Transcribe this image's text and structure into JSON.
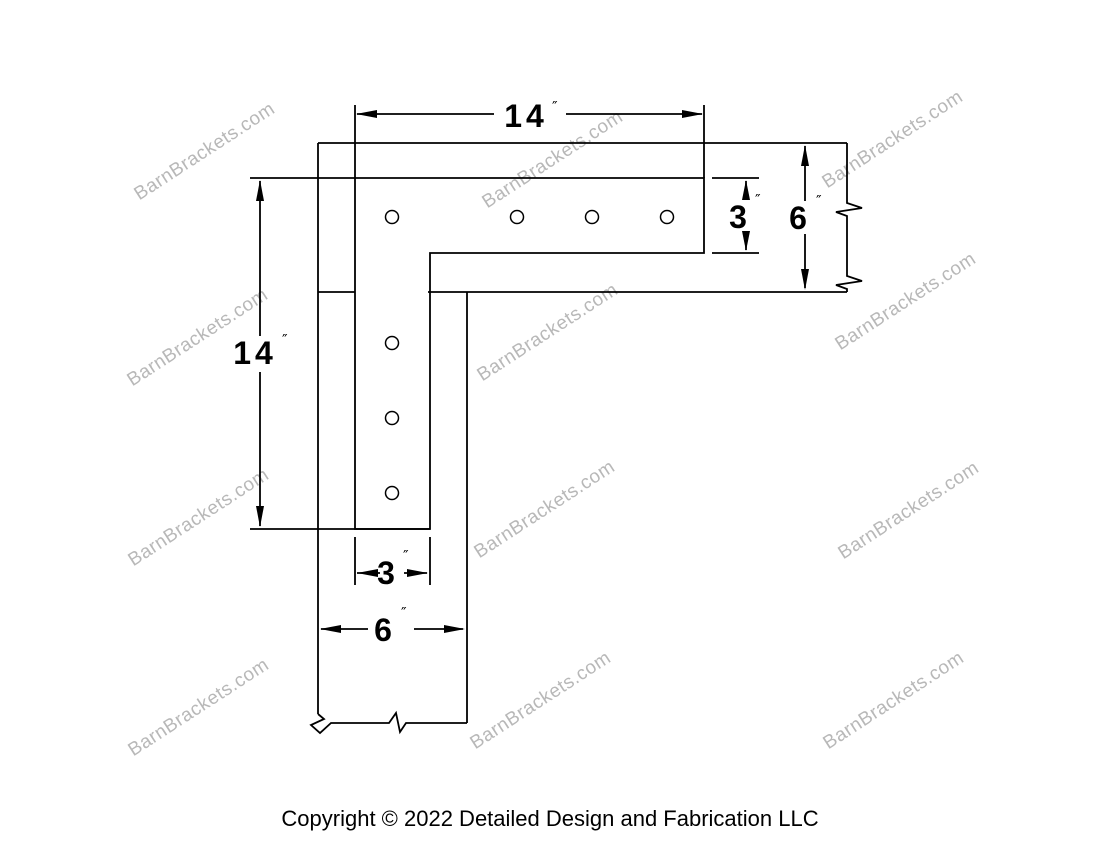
{
  "page": {
    "background": "#ffffff"
  },
  "drawing": {
    "name": "L shaped corner bracket dimension diagram",
    "line_color": "#000000",
    "dimensions": {
      "top_length": {
        "value": "14",
        "unit": "″"
      },
      "plate_height": {
        "value": "3",
        "unit": "″"
      },
      "beam_height": {
        "value": "6",
        "unit": "″"
      },
      "left_length": {
        "value": "14",
        "unit": "″"
      },
      "plate_width": {
        "value": "3",
        "unit": "″"
      },
      "beam_width": {
        "value": "6",
        "unit": "″"
      }
    },
    "holes": [
      {
        "x": 392,
        "y": 217
      },
      {
        "x": 517,
        "y": 217
      },
      {
        "x": 592,
        "y": 217
      },
      {
        "x": 667,
        "y": 217
      },
      {
        "x": 392,
        "y": 343
      },
      {
        "x": 392,
        "y": 418
      },
      {
        "x": 392,
        "y": 493
      }
    ],
    "hole_radius": 6.5
  },
  "watermark": {
    "text": "BarnBrackets.com",
    "color": "#b8b8b8",
    "positions": [
      {
        "x": 205,
        "y": 152
      },
      {
        "x": 553,
        "y": 160
      },
      {
        "x": 893,
        "y": 140
      },
      {
        "x": 198,
        "y": 338
      },
      {
        "x": 548,
        "y": 333
      },
      {
        "x": 906,
        "y": 302
      },
      {
        "x": 199,
        "y": 518
      },
      {
        "x": 545,
        "y": 510
      },
      {
        "x": 909,
        "y": 511
      },
      {
        "x": 199,
        "y": 708
      },
      {
        "x": 541,
        "y": 701
      },
      {
        "x": 894,
        "y": 701
      }
    ]
  },
  "footer": {
    "copyright": "Copyright © 2022 Detailed Design and Fabrication LLC"
  }
}
